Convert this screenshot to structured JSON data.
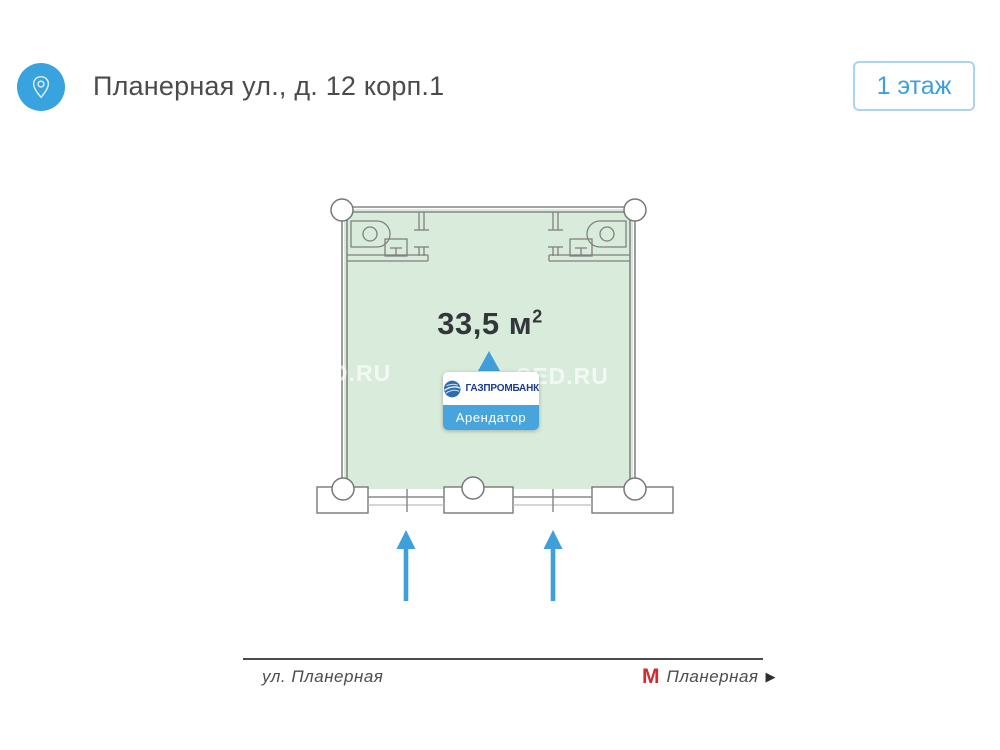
{
  "header": {
    "title": "Планерная ул., д. 12 корп.1",
    "floor_badge": "1 этаж"
  },
  "plan": {
    "area_value": "33,5 м",
    "area_sup": "2",
    "tenant": {
      "brand": "ГАЗПРОМБАНК",
      "label": "Арендатор"
    },
    "watermarks": [
      "D.RU",
      "SED.RU"
    ],
    "entrance_arrow_count": 2
  },
  "footer": {
    "street": "ул. Планерная",
    "metro": {
      "logo": "М",
      "name": "Планерная",
      "arrow": "▶"
    }
  },
  "icons": {
    "header": "location-pin-icon",
    "tenant_logo": "gazprombank-globe-icon",
    "entrance": "arrow-up-icon",
    "tooltip": "triangle-up-icon",
    "metro": "metro-m-logo"
  },
  "colors": {
    "accent_blue": "#3f9fdb",
    "badge_border": "#a9d5f0",
    "room_green": "#d9ecdc",
    "wall_gray": "#868686",
    "metro_red": "#d8272e",
    "brand_blue": "#1d3c8f",
    "tenant_bg": "#47a4dd",
    "title_gray": "#4b4b4b"
  }
}
